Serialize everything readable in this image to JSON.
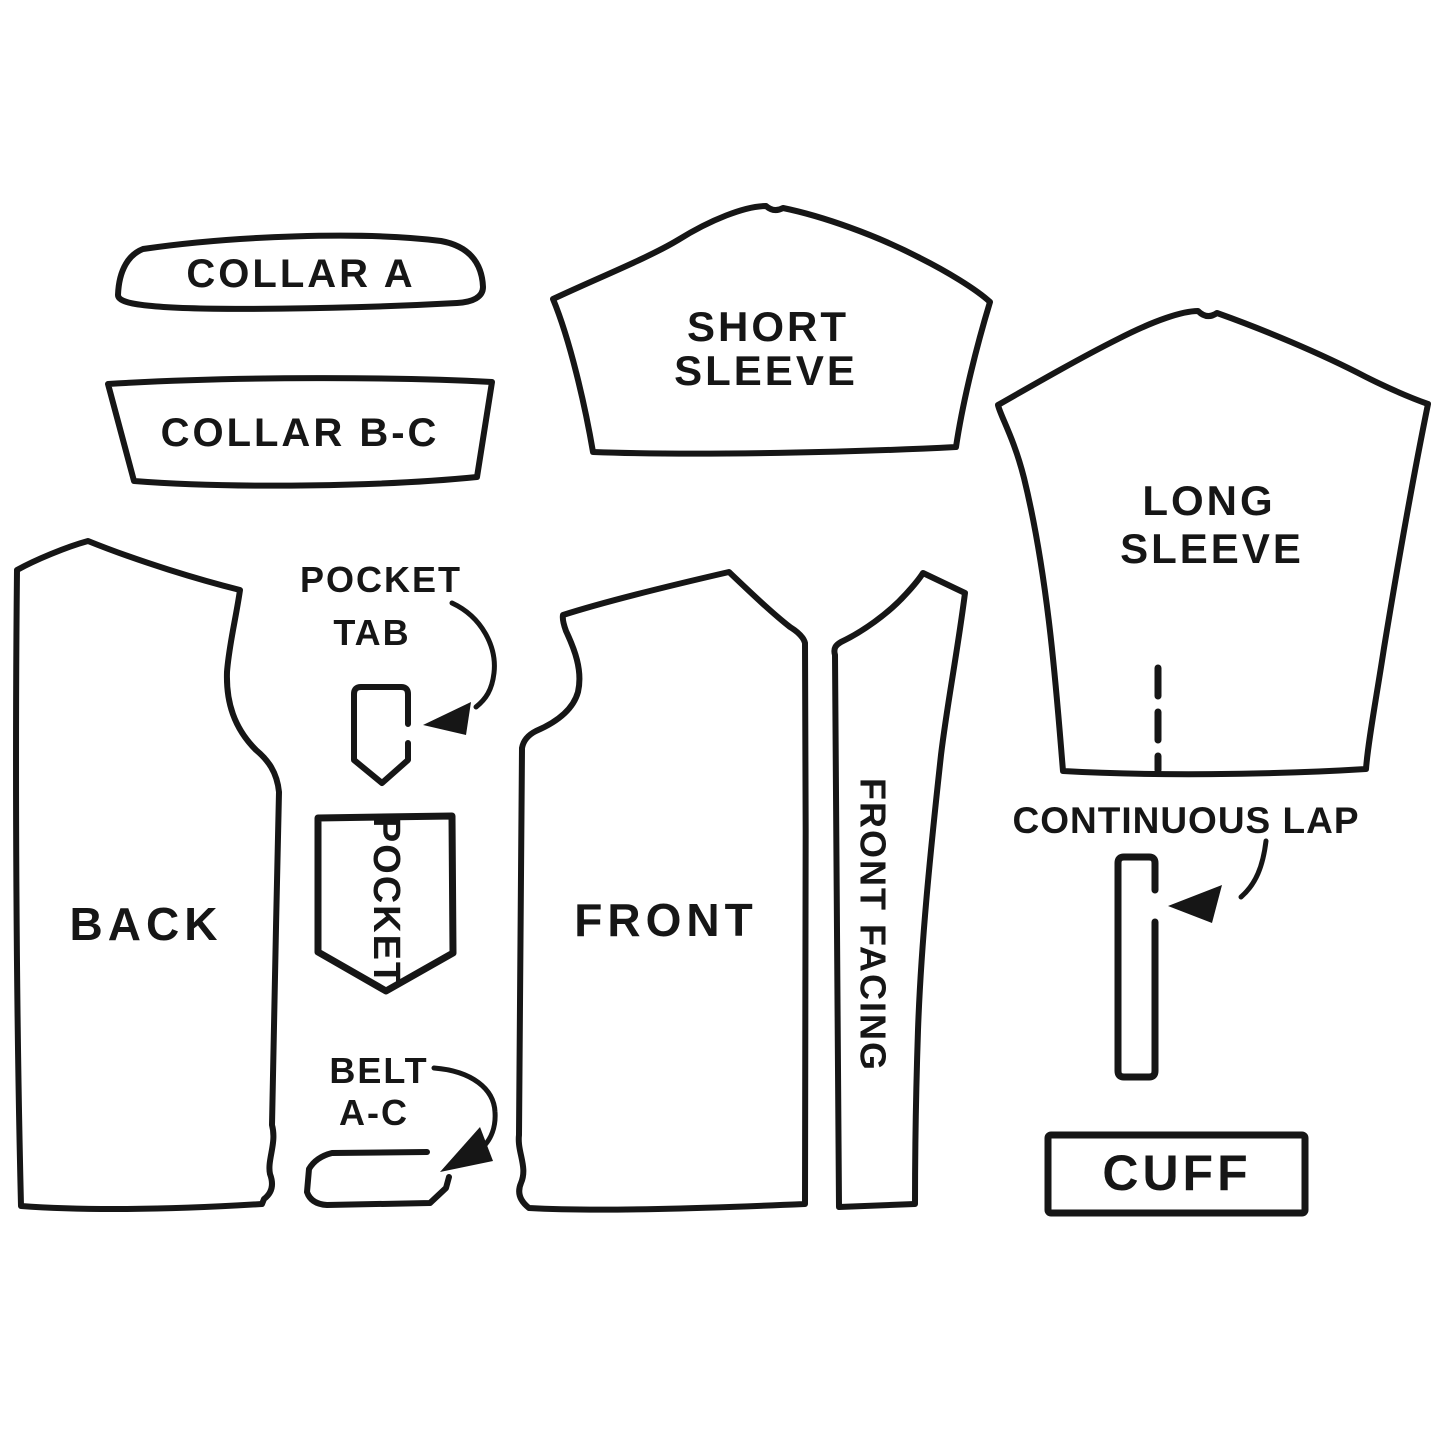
{
  "page": {
    "background_color": "#ffffff",
    "ink_color": "#161616",
    "description": "Sewing pattern piece diagram"
  },
  "pieces": {
    "collar_a": {
      "label": "COLLAR A"
    },
    "collar_bc": {
      "label": "COLLAR B-C"
    },
    "short_sleeve": {
      "line1": "SHORT",
      "line2": "SLEEVE"
    },
    "long_sleeve": {
      "line1": "LONG",
      "line2": "SLEEVE"
    },
    "back": {
      "label": "BACK"
    },
    "pocket_tab": {
      "line1": "POCKET",
      "line2": "TAB"
    },
    "pocket": {
      "label": "POCKET"
    },
    "front": {
      "label": "FRONT"
    },
    "front_facing": {
      "label": "FRONT FACING"
    },
    "belt": {
      "line1": "BELT",
      "line2": "A-C"
    },
    "continuous_lap": {
      "label": "CONTINUOUS LAP"
    },
    "cuff": {
      "label": "CUFF"
    }
  }
}
